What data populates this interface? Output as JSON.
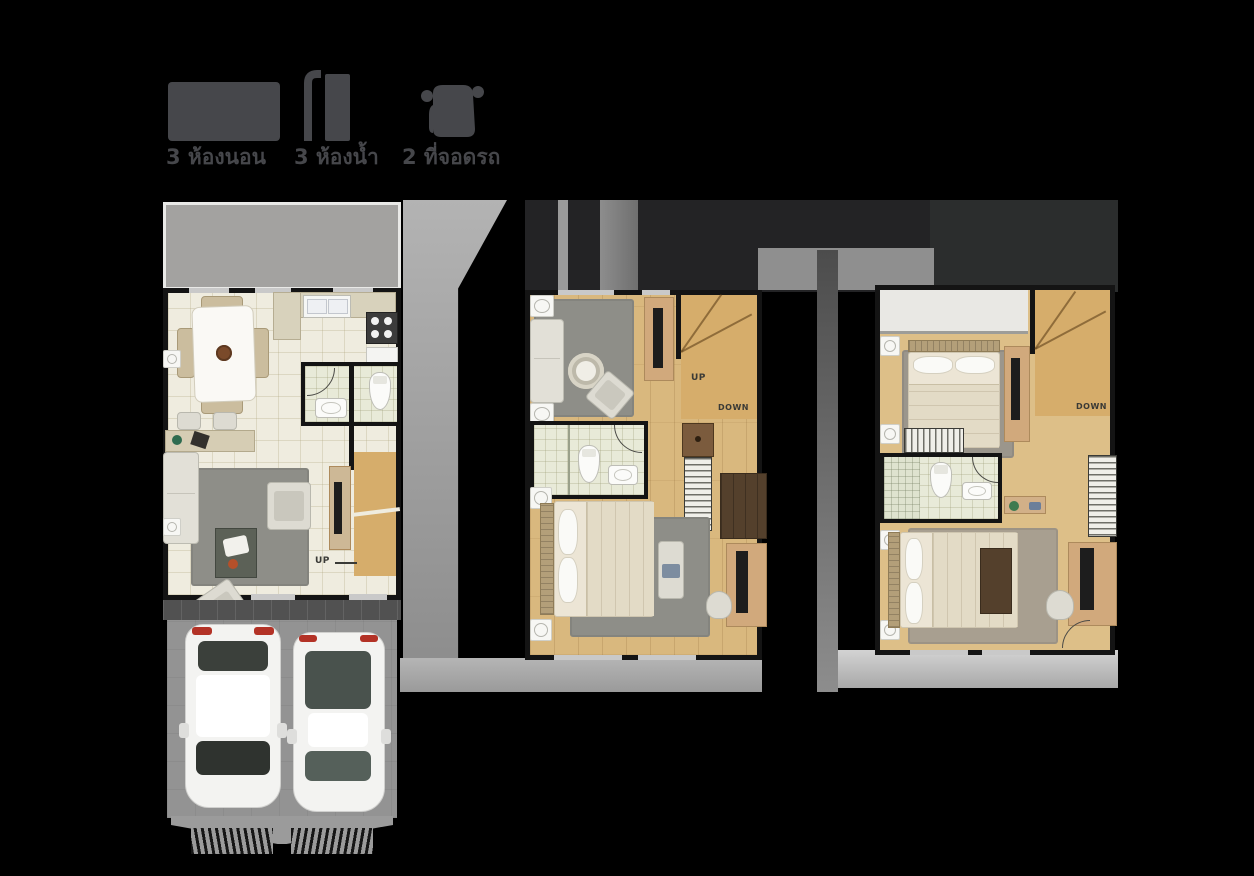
{
  "legend": {
    "items": [
      {
        "icon": "bed-icon",
        "label": "3 ห้องนอน"
      },
      {
        "icon": "shower-icon",
        "label": "3 ห้องน้ำ"
      },
      {
        "icon": "car-icon",
        "label": "2 ที่จอดรถ"
      }
    ]
  },
  "plans": [
    {
      "stairs": {
        "up": "UP"
      }
    },
    {
      "stairs": {
        "up": "UP",
        "down": "DOWN"
      }
    },
    {
      "stairs": {
        "down": "DOWN"
      }
    }
  ],
  "colors": {
    "background": "#000000",
    "legend_gray": "#46474b",
    "floor_cream": "#efecdf",
    "wood_floor": "#d9b87e",
    "terrace_gray": "#a3a2a0",
    "driveway_gray": "#939393",
    "rug_gray": "#8e8e88",
    "wall_black": "#141414",
    "bathroom_floor": "#e8ead8",
    "taillight_red": "#b33226"
  }
}
